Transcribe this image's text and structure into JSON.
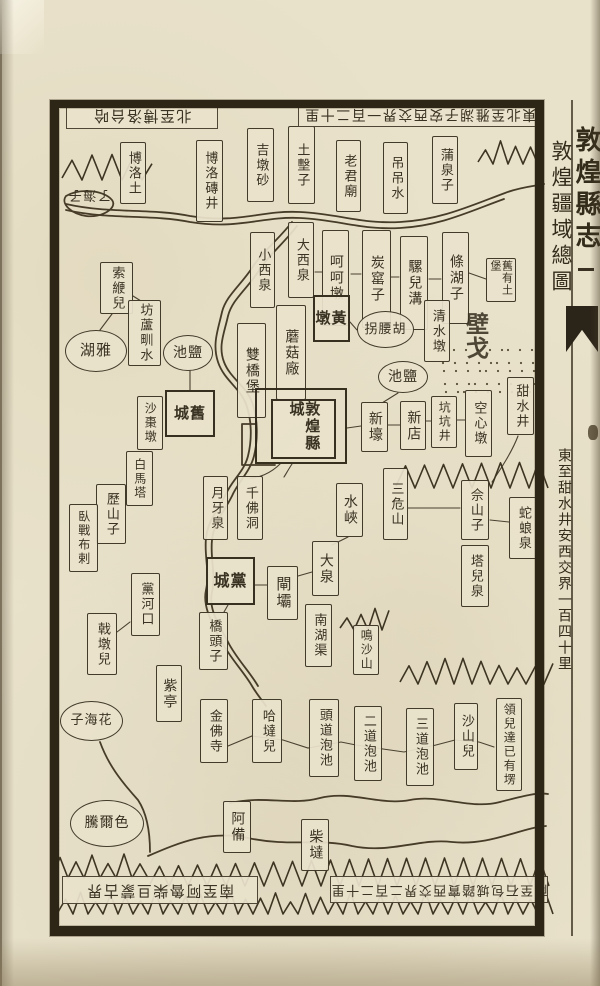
{
  "book": {
    "title": "敦煌縣志",
    "map_title": "敦煌疆域總圖",
    "margin_note_east": "東至甜水井安西交界一百四十里",
    "fishtail_icon": "fish-tail collation mark"
  },
  "edge_inscriptions": {
    "north_west": "北至博洛台哈",
    "north_east": "東北至雅湖子安西交界一百二十里",
    "south_west": "南至阿魯柴旦蒙古界",
    "south_east": "南至石包城踏實西交界二百二十里"
  },
  "colors": {
    "paper": "#e9e2cb",
    "ink": "#3a3222",
    "frame": "#2d2516"
  },
  "features": {
    "desert_label": "戈壁",
    "rivers": [
      "黨河",
      "疏勒河"
    ],
    "county_seat": "敦煌縣城"
  },
  "places": [
    {
      "id": "boluotu",
      "label": "博洛土",
      "type": "box",
      "x": 120,
      "y": 142,
      "w": 26,
      "h": 62,
      "fs": 13
    },
    {
      "id": "boluo-zhuanjing",
      "label": "博洛磚井",
      "type": "box",
      "x": 196,
      "y": 140,
      "w": 27,
      "h": 82,
      "fs": 13
    },
    {
      "id": "jidunsha",
      "label": "吉墩砂",
      "type": "box",
      "x": 247,
      "y": 128,
      "w": 27,
      "h": 74,
      "fs": 13
    },
    {
      "id": "tujizi",
      "label": "土墼子",
      "type": "box",
      "x": 288,
      "y": 126,
      "w": 27,
      "h": 78,
      "fs": 13
    },
    {
      "id": "laojunmiao",
      "label": "老君廟",
      "type": "box",
      "x": 336,
      "y": 140,
      "w": 25,
      "h": 72,
      "fs": 13
    },
    {
      "id": "diaodiaoshui",
      "label": "吊吊水",
      "type": "box",
      "x": 383,
      "y": 142,
      "w": 25,
      "h": 72,
      "fs": 13
    },
    {
      "id": "puquanzi",
      "label": "蒲泉子",
      "type": "box",
      "x": 432,
      "y": 136,
      "w": 26,
      "h": 68,
      "fs": 13
    },
    {
      "id": "liaohaizi",
      "label": "了海子",
      "type": "hlabel noborder",
      "x": 66,
      "y": 182,
      "w": 46,
      "h": 24,
      "fs": 13
    },
    {
      "id": "xiaoxiquan",
      "label": "小西泉",
      "type": "box",
      "x": 250,
      "y": 232,
      "w": 25,
      "h": 76,
      "fs": 13
    },
    {
      "id": "daxiquan",
      "label": "大西泉",
      "type": "box",
      "x": 288,
      "y": 222,
      "w": 26,
      "h": 76,
      "fs": 13
    },
    {
      "id": "hehedun",
      "label": "呵呵墩",
      "type": "box",
      "x": 322,
      "y": 230,
      "w": 27,
      "h": 96,
      "fs": 14
    },
    {
      "id": "tanyaozi",
      "label": "炭窰子",
      "type": "box",
      "x": 362,
      "y": 230,
      "w": 29,
      "h": 98,
      "fs": 14
    },
    {
      "id": "luoergou",
      "label": "騾兒溝",
      "type": "box",
      "x": 400,
      "y": 236,
      "w": 28,
      "h": 94,
      "fs": 14
    },
    {
      "id": "tiaohuzi",
      "label": "條湖子",
      "type": "box",
      "x": 442,
      "y": 232,
      "w": 27,
      "h": 92,
      "fs": 14
    },
    {
      "id": "jiuyou-tubao",
      "label": "舊有土堡",
      "type": "box2",
      "x": 486,
      "y": 258,
      "w": 30,
      "h": 44,
      "fs": 11
    },
    {
      "id": "shuangqiaobao",
      "label": "雙橋堡",
      "type": "box",
      "x": 237,
      "y": 323,
      "w": 29,
      "h": 95,
      "fs": 14
    },
    {
      "id": "mogucang",
      "label": "蘑菇廠",
      "type": "box",
      "x": 276,
      "y": 305,
      "w": 30,
      "h": 95,
      "fs": 14
    },
    {
      "id": "huangdun",
      "label": "黃墩",
      "type": "city",
      "x": 313,
      "y": 295,
      "w": 37,
      "h": 47,
      "fs": 15,
      "rtl": true
    },
    {
      "id": "huyaoguai",
      "label": "胡腰拐",
      "type": "oval",
      "x": 357,
      "y": 311,
      "w": 57,
      "h": 37,
      "fs": 13,
      "rtl": true
    },
    {
      "id": "qingshuidun",
      "label": "清水墩",
      "type": "box",
      "x": 424,
      "y": 300,
      "w": 26,
      "h": 62,
      "fs": 13
    },
    {
      "id": "gebi",
      "label": "戈壁",
      "type": "bigchars",
      "x": 466,
      "y": 322,
      "w": 52,
      "h": 30,
      "rtl": true
    },
    {
      "id": "tianshuijing",
      "label": "甜水井",
      "type": "box",
      "x": 507,
      "y": 377,
      "w": 27,
      "h": 58,
      "fs": 13
    },
    {
      "id": "suobianer",
      "label": "索緶兒",
      "type": "box",
      "x": 100,
      "y": 262,
      "w": 33,
      "h": 52,
      "fs": 13
    },
    {
      "id": "fangluzhenshui",
      "label": "坊蘆甽水",
      "type": "box",
      "x": 128,
      "y": 300,
      "w": 33,
      "h": 66,
      "fs": 13
    },
    {
      "id": "yahu",
      "label": "雅湖",
      "type": "oval",
      "x": 65,
      "y": 330,
      "w": 62,
      "h": 42,
      "fs": 15,
      "rtl": true
    },
    {
      "id": "yanchi-west",
      "label": "鹽池",
      "type": "oval",
      "x": 163,
      "y": 335,
      "w": 50,
      "h": 36,
      "fs": 14,
      "rtl": true
    },
    {
      "id": "yanchi-east",
      "label": "鹽池",
      "type": "oval",
      "x": 378,
      "y": 361,
      "w": 50,
      "h": 32,
      "fs": 14,
      "rtl": true
    },
    {
      "id": "jiucheng",
      "label": "舊城",
      "type": "city",
      "x": 165,
      "y": 390,
      "w": 50,
      "h": 47,
      "fs": 15,
      "rtl": true
    },
    {
      "id": "shazaodun",
      "label": "沙棗墩",
      "type": "box",
      "x": 137,
      "y": 396,
      "w": 26,
      "h": 54,
      "fs": 12
    },
    {
      "id": "dunhuang-xiancheng",
      "label": "敦煌縣城",
      "type": "city-double",
      "x": 255,
      "y": 388,
      "w": 92,
      "h": 76
    },
    {
      "id": "xinhao",
      "label": "新壕",
      "type": "box",
      "x": 361,
      "y": 402,
      "w": 27,
      "h": 50,
      "fs": 14
    },
    {
      "id": "xindian",
      "label": "新店",
      "type": "box",
      "x": 400,
      "y": 401,
      "w": 26,
      "h": 49,
      "fs": 14
    },
    {
      "id": "kengkengjing",
      "label": "坑坑井",
      "type": "box",
      "x": 431,
      "y": 396,
      "w": 26,
      "h": 52,
      "fs": 12
    },
    {
      "id": "kongxindun",
      "label": "空心墩",
      "type": "box",
      "x": 465,
      "y": 390,
      "w": 27,
      "h": 67,
      "fs": 13
    },
    {
      "id": "baimata",
      "label": "白馬塔",
      "type": "box",
      "x": 126,
      "y": 451,
      "w": 27,
      "h": 55,
      "fs": 12
    },
    {
      "id": "lishanzi",
      "label": "歷山子",
      "type": "box",
      "x": 96,
      "y": 484,
      "w": 30,
      "h": 60,
      "fs": 13
    },
    {
      "id": "wozhanbula",
      "label": "臥戰布剌",
      "type": "box",
      "x": 69,
      "y": 504,
      "w": 29,
      "h": 68,
      "fs": 12
    },
    {
      "id": "yueyaquan",
      "label": "月牙泉",
      "type": "box",
      "x": 203,
      "y": 476,
      "w": 25,
      "h": 64,
      "fs": 13
    },
    {
      "id": "qianfodong",
      "label": "千佛洞",
      "type": "box",
      "x": 237,
      "y": 476,
      "w": 26,
      "h": 64,
      "fs": 13
    },
    {
      "id": "shuixia",
      "label": "水峽",
      "type": "box",
      "x": 336,
      "y": 483,
      "w": 27,
      "h": 54,
      "fs": 14
    },
    {
      "id": "sanweishan",
      "label": "三危山",
      "type": "box",
      "x": 383,
      "y": 468,
      "w": 25,
      "h": 72,
      "fs": 13
    },
    {
      "id": "sheshanzi",
      "label": "佘山子",
      "type": "box",
      "x": 461,
      "y": 480,
      "w": 28,
      "h": 60,
      "fs": 13
    },
    {
      "id": "shelangquan",
      "label": "蛇蜋泉",
      "type": "box",
      "x": 509,
      "y": 497,
      "w": 28,
      "h": 62,
      "fs": 13
    },
    {
      "id": "taerquan",
      "label": "塔兒泉",
      "type": "box",
      "x": 461,
      "y": 545,
      "w": 28,
      "h": 62,
      "fs": 13
    },
    {
      "id": "dangcheng",
      "label": "黨城",
      "type": "city",
      "x": 206,
      "y": 557,
      "w": 49,
      "h": 48,
      "fs": 16,
      "rtl": true
    },
    {
      "id": "zhaba",
      "label": "閘壩",
      "type": "box",
      "x": 267,
      "y": 566,
      "w": 31,
      "h": 54,
      "fs": 15
    },
    {
      "id": "daquan",
      "label": "大泉",
      "type": "box",
      "x": 312,
      "y": 541,
      "w": 27,
      "h": 55,
      "fs": 14
    },
    {
      "id": "qiaotouzi",
      "label": "橋頭子",
      "type": "box",
      "x": 199,
      "y": 612,
      "w": 29,
      "h": 58,
      "fs": 13
    },
    {
      "id": "nanhuqu",
      "label": "南湖渠",
      "type": "box",
      "x": 305,
      "y": 604,
      "w": 27,
      "h": 63,
      "fs": 13
    },
    {
      "id": "mingshashan",
      "label": "鳴沙山",
      "type": "box",
      "x": 353,
      "y": 625,
      "w": 26,
      "h": 50,
      "fs": 12
    },
    {
      "id": "ziting",
      "label": "紫亭",
      "type": "box",
      "x": 156,
      "y": 665,
      "w": 26,
      "h": 57,
      "fs": 14
    },
    {
      "id": "jiduner",
      "label": "戟墩兒",
      "type": "box",
      "x": 87,
      "y": 613,
      "w": 30,
      "h": 62,
      "fs": 13
    },
    {
      "id": "danghekou",
      "label": "黨河口",
      "type": "box",
      "x": 131,
      "y": 573,
      "w": 29,
      "h": 63,
      "fs": 13
    },
    {
      "id": "huahaizi",
      "label": "花海子",
      "type": "oval",
      "x": 60,
      "y": 701,
      "w": 63,
      "h": 40,
      "fs": 13,
      "rtl": true
    },
    {
      "id": "jinfosi",
      "label": "金佛寺",
      "type": "box",
      "x": 200,
      "y": 699,
      "w": 28,
      "h": 64,
      "fs": 13
    },
    {
      "id": "hadaer",
      "label": "哈墶兒",
      "type": "box",
      "x": 252,
      "y": 699,
      "w": 30,
      "h": 64,
      "fs": 13
    },
    {
      "id": "toudao-paochi",
      "label": "頭道泡池",
      "type": "box",
      "x": 309,
      "y": 699,
      "w": 30,
      "h": 78,
      "fs": 13
    },
    {
      "id": "erdao-paochi",
      "label": "二道泡池",
      "type": "box",
      "x": 354,
      "y": 706,
      "w": 28,
      "h": 75,
      "fs": 13
    },
    {
      "id": "sandao-paochi",
      "label": "三道泡池",
      "type": "box",
      "x": 406,
      "y": 708,
      "w": 28,
      "h": 78,
      "fs": 13
    },
    {
      "id": "shashaner",
      "label": "沙山兒",
      "type": "box",
      "x": 454,
      "y": 703,
      "w": 24,
      "h": 67,
      "fs": 13
    },
    {
      "id": "lingerda-note",
      "label": "領兒達已有塄",
      "type": "box",
      "x": 496,
      "y": 698,
      "w": 26,
      "h": 93,
      "fs": 12
    },
    {
      "id": "seerteng",
      "label": "色爾騰",
      "type": "oval",
      "x": 70,
      "y": 800,
      "w": 74,
      "h": 47,
      "fs": 14,
      "rtl": true
    },
    {
      "id": "abei",
      "label": "阿備",
      "type": "box",
      "x": 223,
      "y": 801,
      "w": 28,
      "h": 52,
      "fs": 14
    },
    {
      "id": "chaida",
      "label": "柴墶",
      "type": "box",
      "x": 301,
      "y": 819,
      "w": 28,
      "h": 52,
      "fs": 14
    },
    {
      "id": "edge-north-west",
      "label": "北至博洛台哈",
      "type": "hlabel",
      "x": 66,
      "y": 102,
      "w": 152,
      "h": 27,
      "fs": 15
    },
    {
      "id": "edge-north-east",
      "label": "東北至雅湖子安西交界一百二十里",
      "type": "hlabel",
      "x": 298,
      "y": 101,
      "w": 244,
      "h": 26,
      "fs": 14
    },
    {
      "id": "edge-south-west",
      "label": "南至阿魯柴旦蒙古界",
      "type": "hlabel",
      "x": 62,
      "y": 876,
      "w": 196,
      "h": 28,
      "fs": 15
    },
    {
      "id": "edge-south-east",
      "label": "南至石包城踏實西交界二百二十里",
      "type": "hlabel",
      "x": 330,
      "y": 876,
      "w": 218,
      "h": 27,
      "fs": 13
    }
  ]
}
